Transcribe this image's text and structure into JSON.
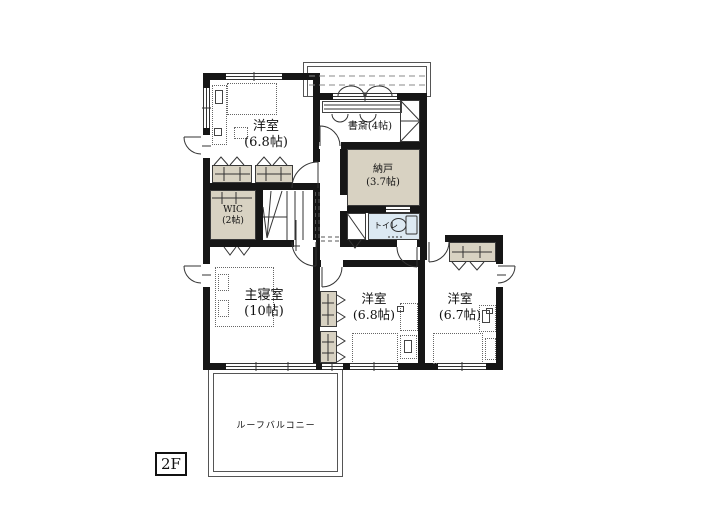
{
  "floor_plan": {
    "floor_label": "2F",
    "rooms": [
      {
        "name": "洋室",
        "size": "(6.8帖)"
      },
      {
        "name": "書斎(4帖)"
      },
      {
        "name": "納戸",
        "size": "(3.7帖)"
      },
      {
        "name": "WIC",
        "size": "(2帖)"
      },
      {
        "name": "トイレ"
      },
      {
        "name": "主寝室",
        "size": "(10帖)"
      },
      {
        "name": "洋室",
        "size": "(6.8帖)"
      },
      {
        "name": "洋室",
        "size": "(6.7帖)"
      },
      {
        "name": "ルーフバルコニー"
      }
    ],
    "colors": {
      "wall": "#161616",
      "closet_fill": "#d8d2c2",
      "toilet_fill": "#dce9f2",
      "line": "#333333"
    }
  }
}
